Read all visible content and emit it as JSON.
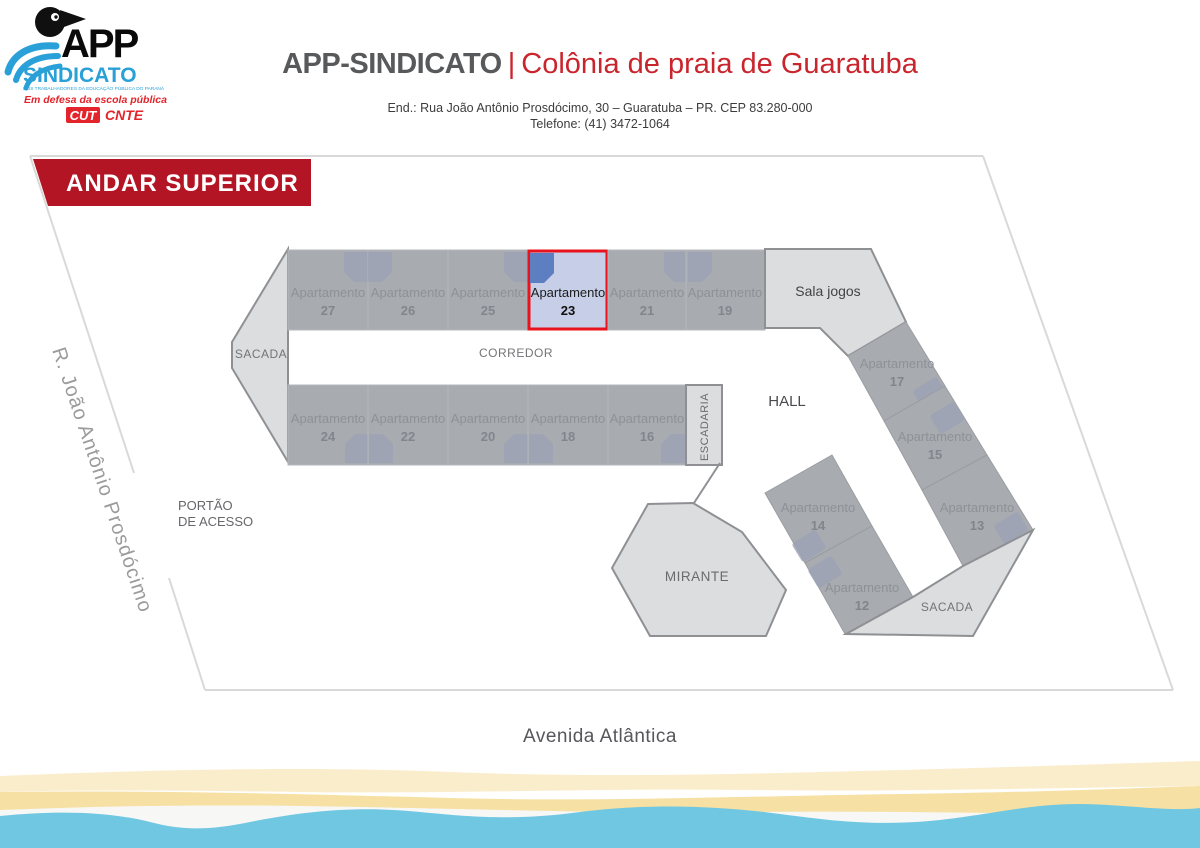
{
  "header": {
    "title_left": "APP-SINDICATO",
    "title_sep": "|",
    "title_right": "Colônia de praia de Guaratuba",
    "address": "End.: Rua João Antônio Prosdócimo, 30 – Guaratuba – PR. CEP 83.280-000",
    "phone": "Telefone: (41) 3472-1064"
  },
  "logo": {
    "app": "APP",
    "sindicato": "SINDICATO",
    "tagline_small": "DOS TRABALHADORES DA EDUCAÇÃO PÚBLICA DO PARANÁ",
    "tagline_script": "Em defesa da escola pública",
    "cut": "CUT",
    "cnte": "CNTE"
  },
  "plan": {
    "banner": "ANDAR SUPERIOR",
    "apartment_word": "Apartamento",
    "highlighted_apartment": "23",
    "top_row": [
      "27",
      "26",
      "25",
      "23",
      "21",
      "19"
    ],
    "bottom_row": [
      "24",
      "22",
      "20",
      "18",
      "16"
    ],
    "right_wing": [
      "17",
      "15",
      "13"
    ],
    "diag_wing": [
      "14",
      "12"
    ],
    "areas": {
      "sacada_left": "SACADA",
      "sacada_right": "SACADA",
      "corredor": "CORREDOR",
      "escadaria": "ESCADARIA",
      "hall": "HALL",
      "mirante": "MIRANTE",
      "sala_jogos": "Sala jogos",
      "portao_line1": "PORTÃO",
      "portao_line2": "DE ACESSO"
    },
    "streets": {
      "left": "R. João Antônio Prosdócimo",
      "bottom": "Avenida Atlântica"
    }
  },
  "colors": {
    "banner_red": "#b41525",
    "highlight_border_red": "#e8131c",
    "highlight_fill_blue": "#c6cfe7",
    "highlight_icon_blue": "#5d7ec1",
    "building_gray": "#a8abaf",
    "area_light_gray": "#dcdddf",
    "logo_blue": "#29a0d8",
    "logo_red": "#e3242b",
    "sand": "#f6e0a3",
    "water": "#70c7e2"
  }
}
